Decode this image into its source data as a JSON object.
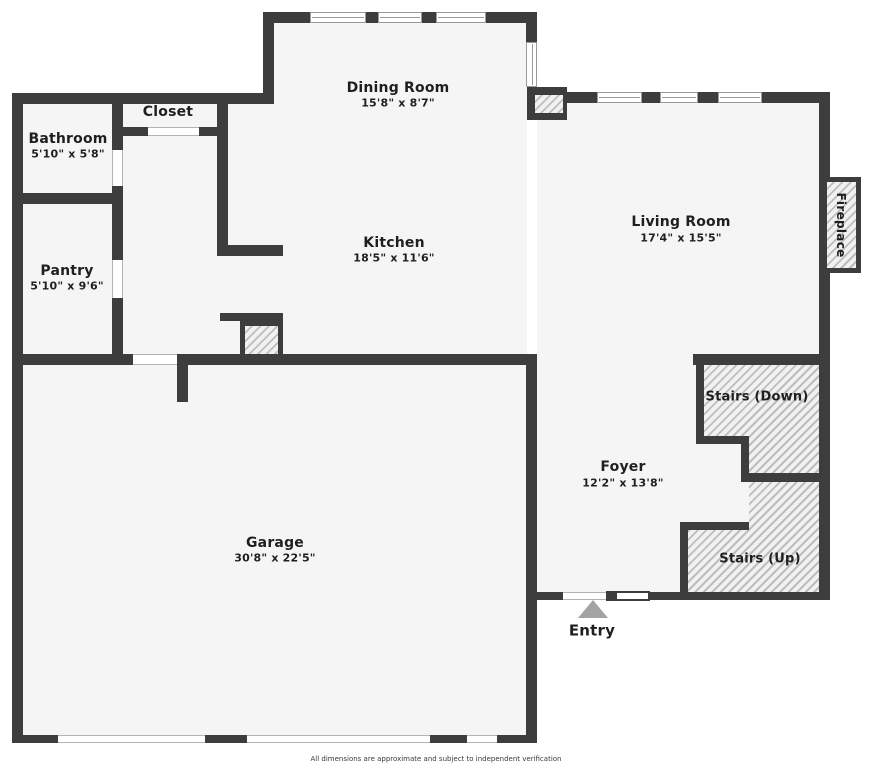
{
  "plan": {
    "rooms": {
      "bathroom": {
        "name": "Bathroom",
        "dims": "5'10\" x 5'8\""
      },
      "closet": {
        "name": "Closet"
      },
      "pantry": {
        "name": "Pantry",
        "dims": "5'10\" x 9'6\""
      },
      "dining_room": {
        "name": "Dining Room",
        "dims": "15'8\" x 8'7\""
      },
      "kitchen": {
        "name": "Kitchen",
        "dims": "18'5\" x 11'6\""
      },
      "living_room": {
        "name": "Living Room",
        "dims": "17'4\" x 15'5\""
      },
      "garage": {
        "name": "Garage",
        "dims": "30'8\" x 22'5\""
      },
      "foyer": {
        "name": "Foyer",
        "dims": "12'2\" x 13'8\""
      },
      "stairs_down": {
        "name": "Stairs (Down)"
      },
      "stairs_up": {
        "name": "Stairs (Up)"
      },
      "fireplace": {
        "name": "Fireplace"
      },
      "entry": {
        "name": "Entry"
      }
    },
    "footer": {
      "disclaimer": "All dimensions are approximate and subject to independent verification"
    },
    "colors": {
      "wall": "#3d3d3d",
      "floor": "#f5f5f5",
      "hatch_stripe": "#bdbdbd",
      "entry_marker": "#a3a3a3"
    }
  }
}
